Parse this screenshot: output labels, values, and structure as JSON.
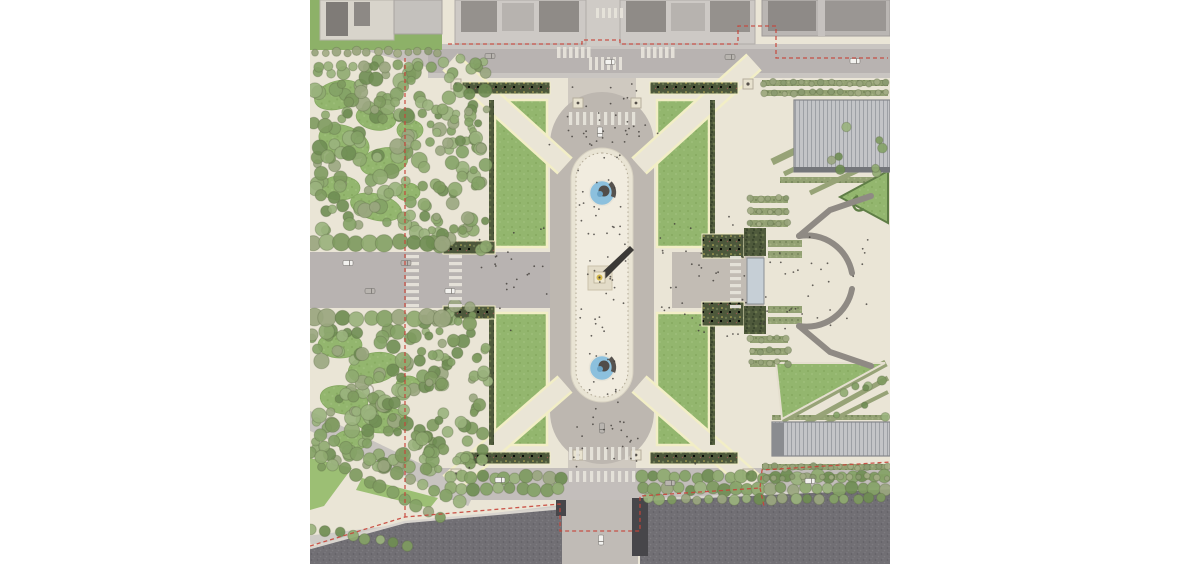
{
  "colors": {
    "pavement": "#eae5d6",
    "pavement_light": "#f1ecdf",
    "pavement_track": "#e9e4d4",
    "road": "#b8b3b1",
    "road_light": "#c6c1bd",
    "road_beige": "#cfc9c0",
    "ring_gray": "#bdb7b0",
    "lawn": "#93b66e",
    "lawn_border": "#f2eec6",
    "hedge_dark": "#4f5a3c",
    "allee_green": "#97a377",
    "water": "#706e73",
    "building": "#cdc9c5",
    "roof_dark": "#8f8b87",
    "fountain_blue": "#8cc0dd",
    "boundary_red": "#c8453a",
    "wall_gray": "#8f8a84",
    "gate_blue": "#c6cfd6",
    "obelisk_gold": "#d4b84a",
    "canvas_white": "#ffffff"
  },
  "features": {
    "map_label": "aerial-site-plan",
    "plaza": "central-plaza",
    "obelisk": "obelisk-with-shadow",
    "north_fountain": "north-fountain-pool",
    "south_fountain": "south-fountain-pool",
    "lawns": "four-lawn-quadrants",
    "west_gardens": "west-gardens-with-winding-paths",
    "east_gardens": "formal-garden-terraces",
    "horseshoe": "horseshoe-ramp-entrance",
    "gate": "garden-entrance-gate",
    "river": "river-with-bridge",
    "bridge": "bridge",
    "buildings": "city-blocks-north",
    "boundary": "red-dashed-project-boundary"
  }
}
